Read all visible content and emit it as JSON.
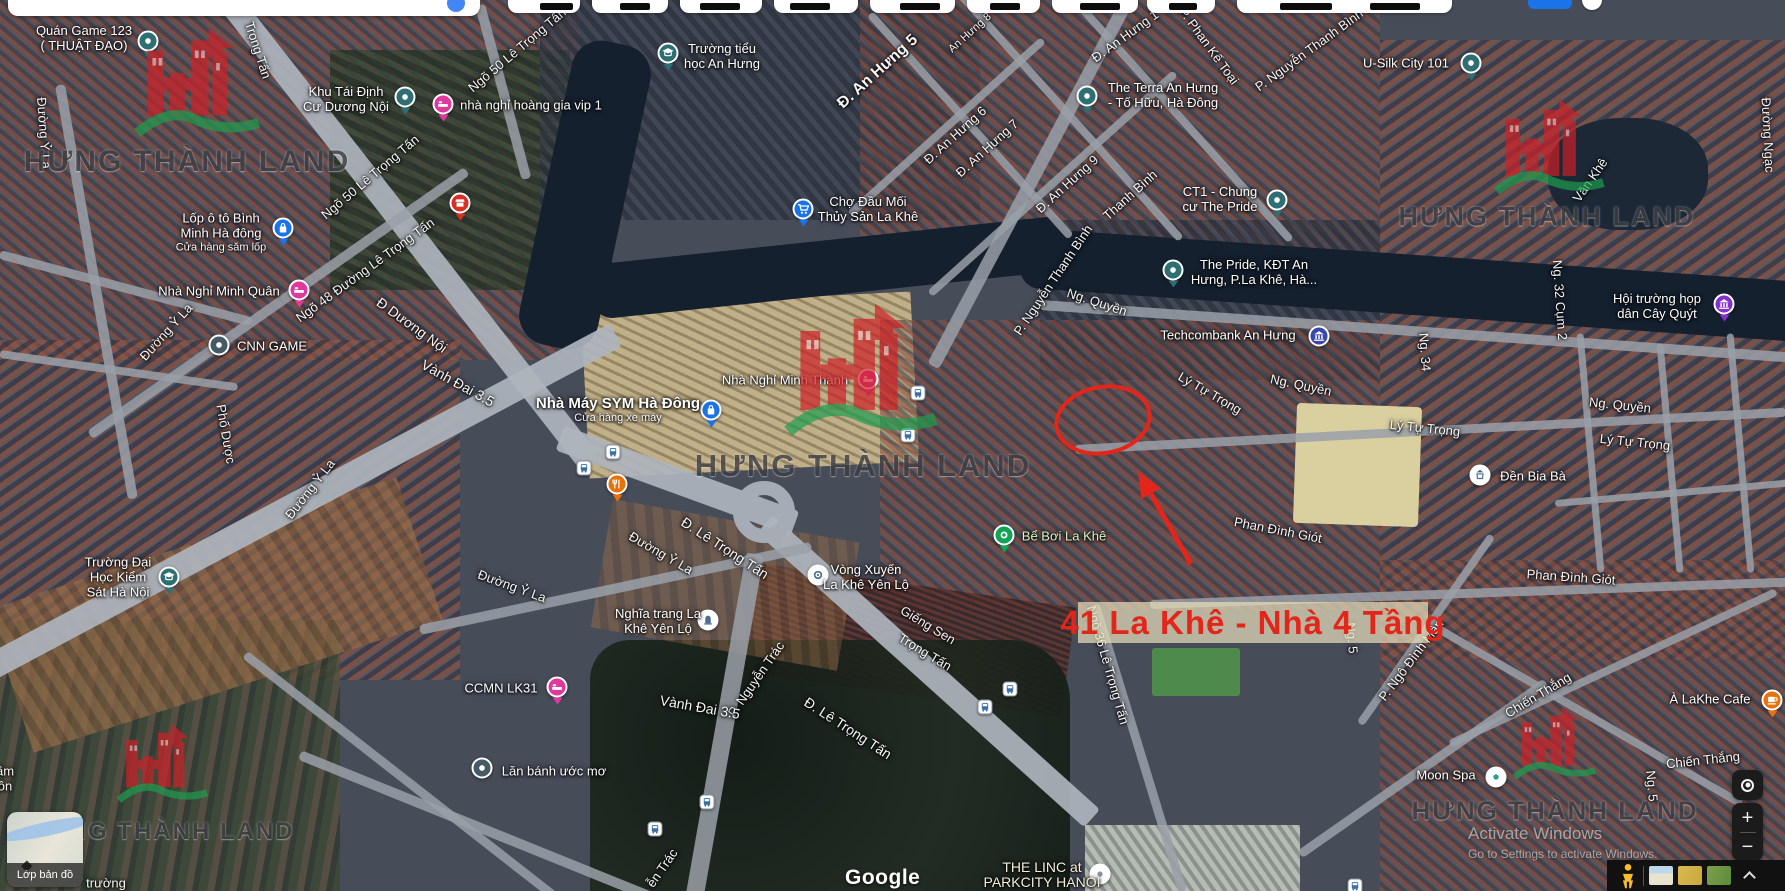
{
  "map": {
    "street_labels": [
      {
        "t": "Đường Ỷ La",
        "x": 44,
        "y": 133,
        "r": 86
      },
      {
        "t": "Trọng Tấn",
        "x": 258,
        "y": 50,
        "r": 72
      },
      {
        "t": "Ngõ 50 Lê Trọng Tấn",
        "x": 370,
        "y": 177,
        "r": -40
      },
      {
        "t": "Ngõ 50 Lê Trọng Tấn",
        "x": 517,
        "y": 50,
        "r": -40
      },
      {
        "t": "Ngõ 48 Đường Lê Trọng Tấn",
        "x": 365,
        "y": 270,
        "r": -36
      },
      {
        "t": "Đ Dương Nội",
        "x": 412,
        "y": 325,
        "r": 36,
        "s": 14
      },
      {
        "t": "Vành Đai 3.5",
        "x": 458,
        "y": 383,
        "r": 29,
        "s": 14
      },
      {
        "t": "Đường Ỷ La",
        "x": 166,
        "y": 332,
        "r": -48
      },
      {
        "t": "Phố Dược",
        "x": 226,
        "y": 434,
        "r": 80
      },
      {
        "t": "Đường Ỷ La",
        "x": 310,
        "y": 489,
        "r": -52
      },
      {
        "t": "Đường Ỷ La",
        "x": 661,
        "y": 553,
        "r": 30
      },
      {
        "t": "Đường Ỷ La",
        "x": 512,
        "y": 586,
        "r": 20
      },
      {
        "t": "Đ. Lê Trọng Tấn",
        "x": 725,
        "y": 548,
        "r": 33,
        "s": 14
      },
      {
        "t": "Giếng Sen",
        "x": 928,
        "y": 625,
        "r": 31
      },
      {
        "t": "Trọng Tấn",
        "x": 925,
        "y": 652,
        "r": 31
      },
      {
        "t": "P. Nguyễn Trác",
        "x": 756,
        "y": 679,
        "r": -55
      },
      {
        "t": "ễn Trác",
        "x": 662,
        "y": 868,
        "r": -55
      },
      {
        "t": "Vành Đai 3.5",
        "x": 700,
        "y": 707,
        "r": 10,
        "s": 14
      },
      {
        "t": "Đ. Lê Trọng Tấn",
        "x": 848,
        "y": 728,
        "r": 33,
        "s": 14
      },
      {
        "t": "Ngõ 36 Lê Trọng Tấn",
        "x": 1108,
        "y": 665,
        "r": 74
      },
      {
        "t": "Ng. 5",
        "x": 1352,
        "y": 638,
        "r": 85
      },
      {
        "t": "Ng. 5",
        "x": 1652,
        "y": 786,
        "r": 85
      },
      {
        "t": "P. Nguyễn Thanh Bình",
        "x": 1053,
        "y": 280,
        "r": -56
      },
      {
        "t": "P. Nguyễn Thanh Bình",
        "x": 1309,
        "y": 50,
        "r": -36
      },
      {
        "t": "P. Phan Kế Toại",
        "x": 1209,
        "y": 46,
        "r": 54
      },
      {
        "t": "Đ. An Hưng 5",
        "x": 878,
        "y": 72,
        "r": -42,
        "s": 16,
        "b": 1
      },
      {
        "t": "An Hưng 8",
        "x": 970,
        "y": 33,
        "r": -42,
        "s": 11
      },
      {
        "t": "Đ. An Hưng 1",
        "x": 1125,
        "y": 36,
        "r": -36
      },
      {
        "t": "Đ. An Hưng 6",
        "x": 955,
        "y": 135,
        "r": -42
      },
      {
        "t": "Đ. An Hưng 7",
        "x": 987,
        "y": 148,
        "r": -42
      },
      {
        "t": "Đ. An Hưng 9",
        "x": 1067,
        "y": 184,
        "r": -42
      },
      {
        "t": "Thanh Bình",
        "x": 1130,
        "y": 195,
        "r": -42
      },
      {
        "t": "Ng. Quyền",
        "x": 1097,
        "y": 302,
        "r": 18
      },
      {
        "t": "Ng. Quyền",
        "x": 1301,
        "y": 385,
        "r": 12
      },
      {
        "t": "Ng. Quyền",
        "x": 1620,
        "y": 405,
        "r": 6
      },
      {
        "t": "Lý Tự Trọng",
        "x": 1210,
        "y": 393,
        "r": 30
      },
      {
        "t": "Lý Tự Trọng",
        "x": 1425,
        "y": 428,
        "r": 6
      },
      {
        "t": "Lý Tự Trọng",
        "x": 1635,
        "y": 442,
        "r": 6
      },
      {
        "t": "Phan Đình Giót",
        "x": 1278,
        "y": 530,
        "r": 11
      },
      {
        "t": "Phan Đình Giót",
        "x": 1571,
        "y": 577,
        "r": 4
      },
      {
        "t": "P. Ngô Đình Mân",
        "x": 1411,
        "y": 660,
        "r": -53
      },
      {
        "t": "Chiến Thắng",
        "x": 1538,
        "y": 695,
        "r": -31
      },
      {
        "t": "Chiến Thắng",
        "x": 1703,
        "y": 760,
        "r": -6
      },
      {
        "t": "Ng. 34",
        "x": 1425,
        "y": 352,
        "r": 86
      },
      {
        "t": "Ng. 32 Cụm 2",
        "x": 1560,
        "y": 300,
        "r": 86
      },
      {
        "t": "Đường Ngạc",
        "x": 1768,
        "y": 135,
        "r": 87
      },
      {
        "t": "Văn Khê",
        "x": 1590,
        "y": 180,
        "r": -55
      },
      {
        "t": "trường",
        "x": 106,
        "y": 883,
        "r": 0
      },
      {
        "t": "ầm",
        "x": 5,
        "y": 771,
        "r": 0
      },
      {
        "t": "ôn",
        "x": 5,
        "y": 786,
        "r": 0
      }
    ],
    "pois": [
      {
        "id": "quan-game-123",
        "lines": [
          "Quán Game 123",
          "( THUẬT ĐẠO)"
        ],
        "tx": 84,
        "ty": 38,
        "ix": 148,
        "iy": 41,
        "icon": "pin-teal"
      },
      {
        "id": "khu-tai-dinh-cu-duong-noi",
        "lines": [
          "Khu Tái Định",
          "Cư Dương Nội"
        ],
        "tx": 346,
        "ty": 99,
        "ix": 405,
        "iy": 97,
        "icon": "pin-teal"
      },
      {
        "id": "nha-nghi-hoang-gia-vip-1",
        "lines": [
          "nhà nghỉ hoàng gia vip 1"
        ],
        "tx": 531,
        "ty": 105,
        "ix": 443,
        "iy": 104,
        "icon": "bed-pink"
      },
      {
        "id": "lop-o-to-binh-minh",
        "lines": [
          "Lốp ô tô Bình",
          "Minh Hà đông",
          "Cửa hàng săm lốp"
        ],
        "styles": [
          "n",
          "n",
          "s"
        ],
        "tx": 221,
        "ty": 233,
        "ix": 283,
        "iy": 228,
        "icon": "bag-blue"
      },
      {
        "id": "truong-tieu-hoc-an-hung",
        "lines": [
          "Trường tiểu",
          "học An Hưng"
        ],
        "tx": 722,
        "ty": 56,
        "ix": 668,
        "iy": 53,
        "icon": "school-teal"
      },
      {
        "id": "cho-dau-moi-thuy-san-la-khe",
        "lines": [
          "Chợ Đầu Mối",
          "Thủy Sản La Khê"
        ],
        "tx": 868,
        "ty": 209,
        "ix": 803,
        "iy": 209,
        "icon": "cart-blue"
      },
      {
        "id": "the-terra-an-hung",
        "lines": [
          "The Terra An Hưng",
          "- Tố Hữu, Hà Đông"
        ],
        "tx": 1163,
        "ty": 95,
        "ix": 1087,
        "iy": 96,
        "icon": "pin-teal"
      },
      {
        "id": "ct1-chung-cu-the-pride",
        "lines": [
          "CT1 - Chung",
          "cư The Pride"
        ],
        "tx": 1220,
        "ty": 199,
        "ix": 1277,
        "iy": 200,
        "icon": "pin-teal"
      },
      {
        "id": "u-silk-city-101",
        "lines": [
          "U-Silk City 101"
        ],
        "tx": 1406,
        "ty": 63,
        "ix": 1471,
        "iy": 63,
        "icon": "pin-teal"
      },
      {
        "id": "the-pride-kdt-an-hung",
        "lines": [
          "The Pride, KĐT An",
          "Hưng, P.La Khê, Hà..."
        ],
        "tx": 1254,
        "ty": 272,
        "ix": 1173,
        "iy": 270,
        "icon": "pin-teal"
      },
      {
        "id": "techcombank-an-hung",
        "lines": [
          "Techcombank An Hưng"
        ],
        "tx": 1228,
        "ty": 335,
        "ix": 1319,
        "iy": 336,
        "icon": "bank-blue"
      },
      {
        "id": "hoi-truong-hop-dan-cay-quyt",
        "lines": [
          "Hội trường họp",
          "dân Cây Quýt"
        ],
        "tx": 1657,
        "ty": 306,
        "ix": 1724,
        "iy": 304,
        "icon": "civic-purple"
      },
      {
        "id": "nha-nghi-minh-quan",
        "lines": [
          "Nhà Nghỉ Minh Quân"
        ],
        "tx": 219,
        "ty": 291,
        "ix": 299,
        "iy": 290,
        "icon": "bed-pink"
      },
      {
        "id": "cnn-game",
        "lines": [
          "CNN GAME"
        ],
        "tx": 272,
        "ty": 346,
        "ix": 219,
        "iy": 345,
        "icon": "dot-dark"
      },
      {
        "id": "nha-may-sym-ha-dong",
        "lines": [
          "Nhà Máy SYM Hà Đông",
          "Cửa hàng xe máy"
        ],
        "styles": [
          "b",
          "s"
        ],
        "tx": 618,
        "ty": 411,
        "ix": 711,
        "iy": 410,
        "icon": "bag-blue"
      },
      {
        "id": "nha-nghi-minh-thanh",
        "lines": [
          "Nhà Nghỉ Minh Thành"
        ],
        "tx": 785,
        "ty": 380,
        "ix": 868,
        "iy": 379,
        "icon": "bed-pink"
      },
      {
        "id": "den-bia-ba",
        "lines": [
          "Đền Bia Bà"
        ],
        "tx": 1533,
        "ty": 476,
        "ix": 1480,
        "iy": 475,
        "icon": "temple-white"
      },
      {
        "id": "be-boi-la-khe",
        "lines": [
          "Bể Bơi La Khê"
        ],
        "tx": 1064,
        "ty": 536,
        "ix": 1004,
        "iy": 535,
        "icon": "pool-green",
        "c": "#d9f2c4"
      },
      {
        "id": "vong-xuyen-la-khe-yen-lo",
        "lines": [
          "Vòng Xuyến",
          "La Khê Yên Lộ"
        ],
        "tx": 866,
        "ty": 577,
        "ix": 818,
        "iy": 575,
        "icon": "round-white"
      },
      {
        "id": "truong-dai-hoc-kiem-sat-ha-noi",
        "lines": [
          "Trường Đại",
          "Học Kiểm",
          "Sát Hà Nội"
        ],
        "tx": 118,
        "ty": 577,
        "ix": 169,
        "iy": 577,
        "icon": "school-teal"
      },
      {
        "id": "nghia-trang-la-khe-yen-lo",
        "lines": [
          "Nghĩa trang La",
          "Khê Yên Lộ"
        ],
        "tx": 658,
        "ty": 621,
        "ix": 708,
        "iy": 620,
        "icon": "grave-white"
      },
      {
        "id": "ccmn-lk31",
        "lines": [
          "CCMN LK31"
        ],
        "tx": 501,
        "ty": 688,
        "ix": 557,
        "iy": 687,
        "icon": "bed-pink"
      },
      {
        "id": "lan-banh-uoc-mo",
        "lines": [
          "Lăn bánh ước mơ"
        ],
        "tx": 554,
        "ty": 771,
        "ix": 482,
        "iy": 768,
        "icon": "dot-dark"
      },
      {
        "id": "moon-spa",
        "lines": [
          "Moon Spa"
        ],
        "tx": 1446,
        "ty": 775,
        "ix": 1496,
        "iy": 777,
        "icon": "spa-white"
      },
      {
        "id": "a-lakhe-cafe",
        "lines": [
          "À LaKhe Cafe"
        ],
        "tx": 1710,
        "ty": 699,
        "ix": 1772,
        "iy": 700,
        "icon": "cafe-orange"
      },
      {
        "id": "restaurant",
        "lines": [],
        "ix": 617,
        "iy": 484,
        "icon": "food-orange"
      },
      {
        "id": "store",
        "lines": [],
        "ix": 460,
        "iy": 203,
        "icon": "store-red"
      },
      {
        "id": "the-linc-parkcity",
        "lines": [
          "THE LINC at",
          "PARKCITY HANOI"
        ],
        "tx": 1042,
        "ty": 875,
        "ix": 1100,
        "iy": 874,
        "icon": "pin-white",
        "c": "#f3edd9",
        "s": 14
      }
    ],
    "bus_stops": [
      [
        613,
        452
      ],
      [
        584,
        468
      ],
      [
        918,
        393
      ],
      [
        908,
        435
      ],
      [
        655,
        829
      ],
      [
        707,
        802
      ],
      [
        985,
        707
      ],
      [
        1010,
        689
      ],
      [
        1355,
        886
      ]
    ],
    "watermark": {
      "text": "HƯNG THÀNH LAND"
    },
    "watermarks": [
      {
        "x": 198,
        "y": 88,
        "h": 125,
        "tx": 187,
        "ty": 162,
        "fs": 30
      },
      {
        "x": 1550,
        "y": 152,
        "h": 110,
        "tx": 1547,
        "ty": 217,
        "fs": 27
      },
      {
        "x": 862,
        "y": 376,
        "h": 152,
        "tx": 863,
        "ty": 466,
        "fs": 31
      },
      {
        "x": 163,
        "y": 768,
        "h": 91,
        "tx": 161,
        "ty": 832,
        "fs": 24
      },
      {
        "x": 1555,
        "y": 748,
        "h": 83,
        "tx": 1555,
        "ty": 811,
        "fs": 26
      }
    ]
  },
  "annotation": {
    "callout_text": "41 La Khê - Nhà 4 Tầng",
    "color": "#e4251a",
    "circle": {
      "cx": 1103,
      "cy": 420,
      "rx": 47,
      "ry": 33
    },
    "arrow": {
      "x1": 1191,
      "y1": 564,
      "x2": 1151,
      "y2": 494
    },
    "arrow_head": "1138,471 1160.5,488.2 1141.3,499.1",
    "callout_box": {
      "x": 1078,
      "y": 602,
      "w": 350,
      "h": 41
    }
  },
  "controls": {
    "layers_label": "Lớp bản đồ",
    "zoom_in": "+",
    "zoom_out": "−",
    "google": "Google",
    "activate_line1": "Activate Windows",
    "activate_line2": "Go to Settings to activate Windows."
  }
}
